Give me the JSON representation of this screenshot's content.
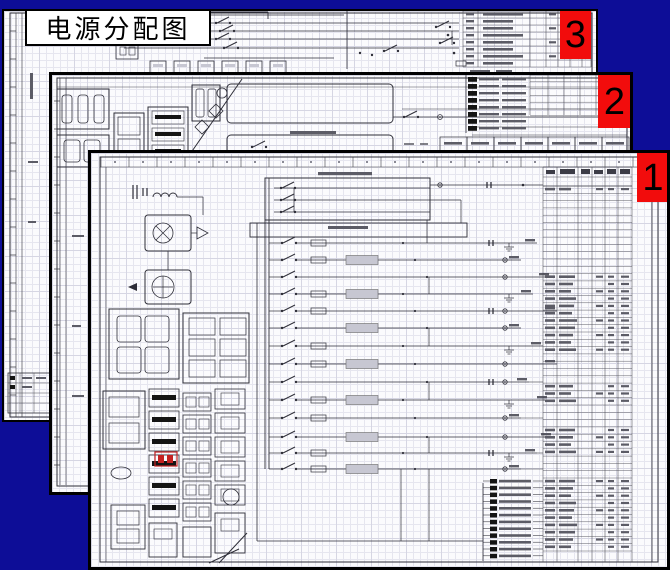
{
  "slide": {
    "title": "电源分配图"
  },
  "sheets": [
    {
      "id": "sheet-1",
      "badge": "1",
      "description": "front wiring diagram page"
    },
    {
      "id": "sheet-2",
      "badge": "2",
      "description": "middle wiring diagram page"
    },
    {
      "id": "sheet-3",
      "badge": "3",
      "description": "back wiring diagram page"
    }
  ],
  "colors": {
    "background": "#0d0d97",
    "paper": "#fbfbfd",
    "grid_minor": "#e6e6ef",
    "grid_major": "#d6d6e3",
    "badge": "#f20c0c",
    "badge_text": "#000000",
    "ink": "#2e2e38",
    "table_line": "#4a4a55",
    "microtext": "#5c5c66",
    "block": "#141414",
    "gray_fill": "#c7c7d2",
    "highlight_red": "#c42222"
  }
}
